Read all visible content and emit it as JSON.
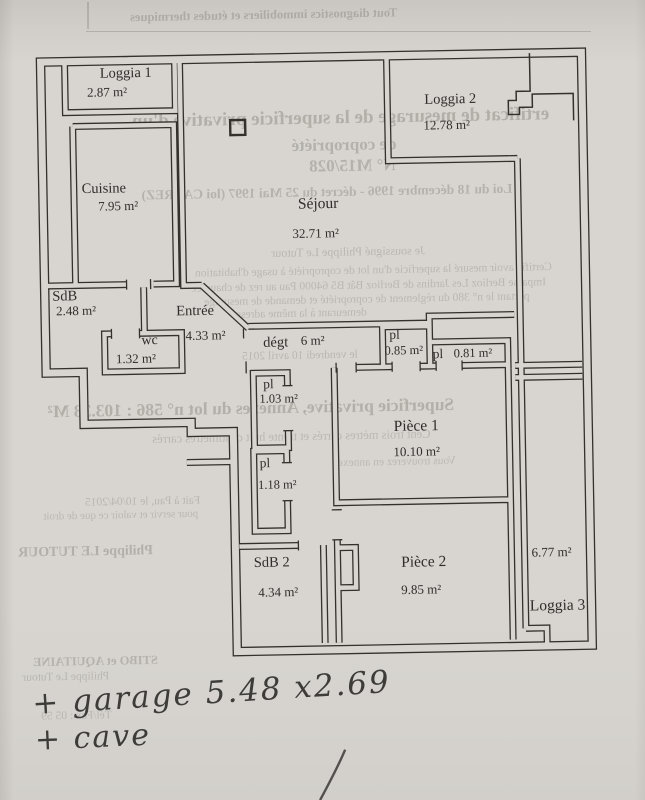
{
  "plan": {
    "rooms": [
      {
        "id": "loggia1",
        "name": "Loggia 1",
        "area": "2.87 m²"
      },
      {
        "id": "cuisine",
        "name": "Cuisine",
        "area": "7.95 m²"
      },
      {
        "id": "sejour",
        "name": "Séjour",
        "area": "32.71 m²"
      },
      {
        "id": "loggia2",
        "name": "Loggia 2",
        "area": "12.78 m²"
      },
      {
        "id": "sdb",
        "name": "SdB",
        "area": "2.48 m²"
      },
      {
        "id": "entree",
        "name": "Entrée",
        "area": "4.33 m²"
      },
      {
        "id": "wc",
        "name": "wc",
        "area": "1.32 m²"
      },
      {
        "id": "degt",
        "name": "dégt",
        "area": "6 m²"
      },
      {
        "id": "pl-085",
        "name": "pl",
        "area": "0.85 m²"
      },
      {
        "id": "pl-081",
        "name": "pl",
        "area": "0.81 m²"
      },
      {
        "id": "pl-103",
        "name": "pl",
        "area": "1.03 m²"
      },
      {
        "id": "pl-118",
        "name": "pl",
        "area": "1.18 m²"
      },
      {
        "id": "piece1",
        "name": "Pièce 1",
        "area": "10.10 m²"
      },
      {
        "id": "piece2",
        "name": "Pièce 2",
        "area": "9.85 m²"
      },
      {
        "id": "sdb2",
        "name": "SdB 2",
        "area": "4.34 m²"
      },
      {
        "id": "loggia3",
        "name": "Loggia 3",
        "area": "6.77 m²"
      }
    ]
  },
  "handwriting": {
    "garage_note": "+ garage 5.48 x2.69",
    "cave_note": "+ cave"
  },
  "bleedthrough": {
    "items": [
      "Tout diagnostics immobiliers et études thermiques",
      "ertificat de mesurage de la superficie privative d'un",
      "de copropriété",
      "N° M15/028",
      "Loi du 18 décembre 1996 - décret du 25 Mai 1997 (loi CARREZ)",
      "Je soussigné Philippe Le Tutour",
      "Certifie avoir mesuré la superficie d'un lot de copropriété à usage d'habitation",
      "Impasse Berlioz Les Jardins de Berlioz Bât B5 64000 Pau au rez de chaussée",
      "portant le n° 380 du règlement de copropriété et demande de mesurage",
      "demeurant à la même adresse",
      "le vendredi 10 avril 2015",
      "Superficie privative, Annexes du lot n° 586 : 103.38 M²",
      "Cent trois mètres carrés et trente huit centimètres carrés",
      "Vous trouverez en annexe",
      "Fait à Pau, le 10/04/2015",
      "pour servir et valoir ce que de droit",
      "Philippe LE TUTOUR",
      "STIBO et AQUITAINE",
      "Philippe Le Tutour",
      "Tél/Fax : 05 59"
    ]
  },
  "colors": {
    "paper": "#d8d5d0",
    "wall_ink": "#34312d",
    "bleed_text": "#8d8b84",
    "pen_ink": "#3d3c39"
  }
}
